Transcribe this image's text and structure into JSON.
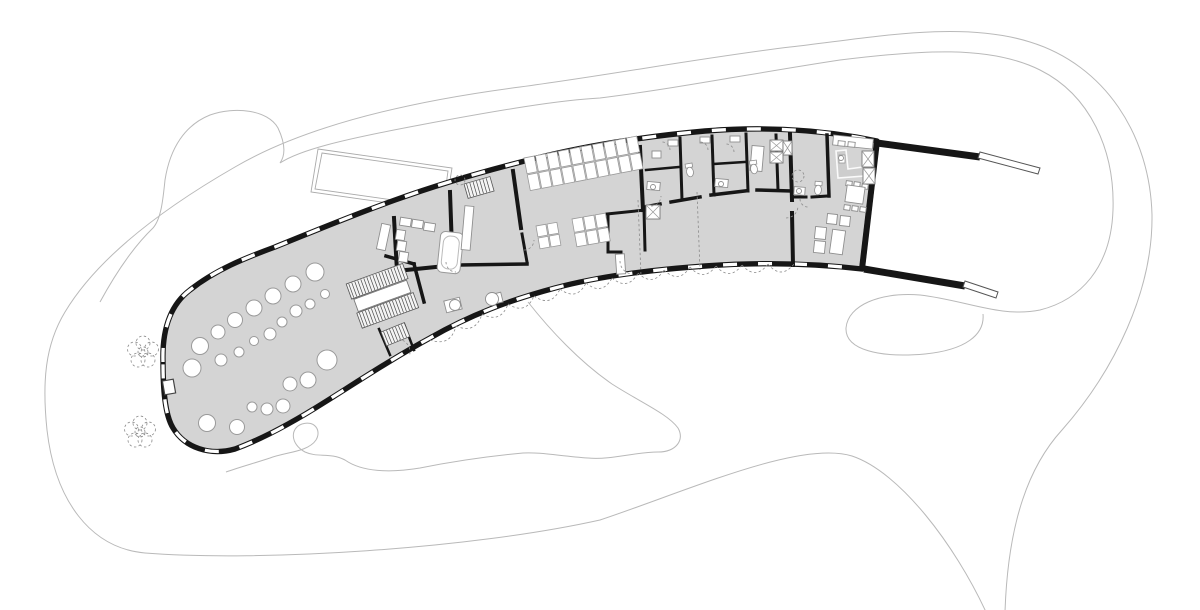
{
  "palette": {
    "background": "#ffffff",
    "floor": "#d4d4d4",
    "wall": "#161616",
    "contour": "#b9b9b9",
    "furniture_stroke": "#8f8f8f",
    "thin_line": "#9a9a9a",
    "hatch": "#4a4a4a",
    "dashed": "#8a8a8a",
    "window": "#ffffff",
    "counter_fill": "#cdcdcd"
  },
  "columns": [
    [
      315,
      272,
      9
    ],
    [
      293,
      284,
      8
    ],
    [
      273,
      296,
      8
    ],
    [
      254,
      308,
      8
    ],
    [
      235,
      320,
      7.5
    ],
    [
      218,
      332,
      7
    ],
    [
      200,
      346,
      8.5
    ],
    [
      192,
      368,
      9
    ],
    [
      207,
      423,
      8.5
    ],
    [
      237,
      427,
      7.5
    ],
    [
      252,
      407,
      5
    ],
    [
      267,
      409,
      6
    ],
    [
      283,
      406,
      7
    ],
    [
      290,
      384,
      7
    ],
    [
      308,
      380,
      8
    ],
    [
      327,
      360,
      10
    ],
    [
      310,
      304,
      5
    ],
    [
      325,
      294,
      4.5
    ],
    [
      296,
      311,
      6
    ],
    [
      282,
      322,
      5
    ],
    [
      270,
      334,
      6
    ],
    [
      254,
      341,
      4.5
    ],
    [
      239,
      352,
      5
    ],
    [
      221,
      360,
      6
    ]
  ],
  "skylight": {
    "x": 524,
    "y": 158,
    "angle": -11,
    "cols": 10,
    "rows": 2,
    "cw": 10.4,
    "ch": 16,
    "gap": 1.2
  },
  "tables": [
    {
      "x": 536,
      "y": 226,
      "angle": -10,
      "cols": 2,
      "rows": 2,
      "cw": 10,
      "ch": 11
    },
    {
      "x": 572,
      "y": 219,
      "angle": -10,
      "cols": 3,
      "rows": 2,
      "cw": 10.5,
      "ch": 13.5
    }
  ],
  "stairs": [
    {
      "x": 352,
      "y": 300,
      "angle": -20,
      "step": 3.2,
      "flights": [
        {
          "ox": 0,
          "oy": -17,
          "w": 60,
          "h": 16
        },
        {
          "ox": 0,
          "oy": 14,
          "w": 60,
          "h": 16
        }
      ],
      "landing": {
        "ox": 2,
        "oy": 0,
        "w": 56,
        "h": 13
      }
    },
    {
      "x": 381,
      "y": 332,
      "angle": -22,
      "step": 3.2,
      "flights": [
        {
          "ox": 0,
          "oy": 0,
          "w": 25,
          "h": 15
        }
      ]
    },
    {
      "x": 464,
      "y": 184,
      "angle": -16,
      "step": 3.4,
      "flights": [
        {
          "ox": 0,
          "oy": 0,
          "w": 27,
          "h": 15
        }
      ]
    }
  ],
  "furniture_rects": [
    [
      400,
      218,
      11,
      8,
      9
    ],
    [
      412,
      220,
      11,
      8,
      9
    ],
    [
      424,
      223,
      11,
      8,
      9
    ],
    [
      396,
      230,
      9,
      10,
      9
    ],
    [
      397,
      241,
      9,
      10,
      9
    ],
    [
      399,
      252,
      9,
      10,
      9
    ],
    [
      445,
      299,
      16,
      12,
      -14
    ],
    [
      494,
      293,
      8,
      10,
      -14
    ],
    [
      652,
      151,
      9,
      7,
      0
    ],
    [
      668,
      140,
      10,
      6,
      0
    ],
    [
      700,
      137,
      10,
      6,
      0
    ],
    [
      730,
      136,
      10,
      6,
      0
    ],
    [
      647,
      182,
      13,
      8,
      5
    ],
    [
      715,
      179,
      13,
      8,
      5
    ],
    [
      794,
      187,
      11,
      8,
      4
    ],
    [
      833,
      137,
      40,
      10,
      6
    ],
    [
      838,
      141,
      7,
      5,
      6
    ],
    [
      848,
      142,
      7,
      5,
      6
    ],
    [
      846,
      181,
      6,
      5,
      8
    ],
    [
      854,
      182,
      6,
      5,
      8
    ],
    [
      862,
      184,
      6,
      5,
      8
    ],
    [
      844,
      205,
      6,
      5,
      8
    ],
    [
      852,
      206,
      6,
      5,
      8
    ],
    [
      860,
      207,
      6,
      5,
      8
    ],
    [
      846,
      186,
      18,
      17,
      8
    ],
    [
      827,
      214,
      10,
      10,
      6
    ],
    [
      840,
      216,
      10,
      10,
      6
    ],
    [
      815,
      227,
      11,
      12,
      6
    ],
    [
      814,
      241,
      11,
      12,
      6
    ],
    [
      831,
      230,
      13,
      24,
      8
    ],
    [
      751,
      146,
      12,
      25,
      5
    ]
  ],
  "door_leaves": [
    [
      463,
      206,
      9,
      44,
      5
    ],
    [
      616,
      254,
      9,
      20,
      -4
    ],
    [
      379,
      224,
      9,
      26,
      12
    ]
  ],
  "small_circles": [
    [
      455,
      305,
      5.5
    ],
    [
      492,
      299,
      6.5
    ],
    [
      653,
      187,
      2.5
    ],
    [
      721,
      184,
      2.5
    ],
    [
      799,
      191,
      2.5
    ],
    [
      841,
      158,
      2.5
    ]
  ],
  "toilets": [
    [
      690,
      172,
      -10
    ],
    [
      754,
      169,
      -8
    ],
    [
      818,
      190,
      5
    ]
  ],
  "xboxes": [
    [
      646,
      205,
      14,
      14
    ],
    [
      770,
      140,
      13,
      11
    ],
    [
      770,
      152,
      13,
      11
    ],
    [
      783,
      141,
      9,
      14
    ],
    [
      862,
      151,
      12,
      16
    ],
    [
      863,
      168,
      12,
      16
    ]
  ],
  "plants_dashed": [
    [
      798,
      176,
      6
    ],
    [
      460,
      180,
      5
    ]
  ],
  "flowers": [
    [
      143,
      352
    ],
    [
      140,
      432
    ]
  ],
  "flower_petal_offsets": [
    [
      0,
      -9
    ],
    [
      8.5,
      -3
    ],
    [
      5,
      8
    ],
    [
      -5,
      8
    ],
    [
      -8.5,
      -3
    ]
  ],
  "door_swings": [
    [
      397,
      352,
      13,
      10
    ],
    [
      456,
      262,
      10,
      180
    ],
    [
      524,
      240,
      10,
      90
    ],
    [
      633,
      261,
      13,
      180
    ],
    [
      651,
      196,
      10,
      90
    ],
    [
      662,
      150,
      8,
      0
    ],
    [
      700,
      150,
      8,
      0
    ],
    [
      726,
      152,
      8,
      0
    ],
    [
      786,
      206,
      12,
      90
    ],
    [
      808,
      199,
      8,
      180
    ]
  ],
  "dashed_lines": [
    [
      638,
      200,
      641,
      276
    ],
    [
      697,
      192,
      700,
      270
    ]
  ],
  "scallop_edge_points": [
    [
      430,
      340
    ],
    [
      456,
      326
    ],
    [
      482,
      314
    ],
    [
      508,
      304
    ],
    [
      534,
      296
    ],
    [
      560,
      289
    ],
    [
      586,
      283
    ],
    [
      612,
      278
    ],
    [
      638,
      273
    ],
    [
      664,
      270
    ],
    [
      690,
      267
    ],
    [
      716,
      266
    ],
    [
      742,
      265
    ],
    [
      768,
      264
    ],
    [
      794,
      264
    ]
  ],
  "window_dash": {
    "pattern": "14 21",
    "width": 3.3
  }
}
